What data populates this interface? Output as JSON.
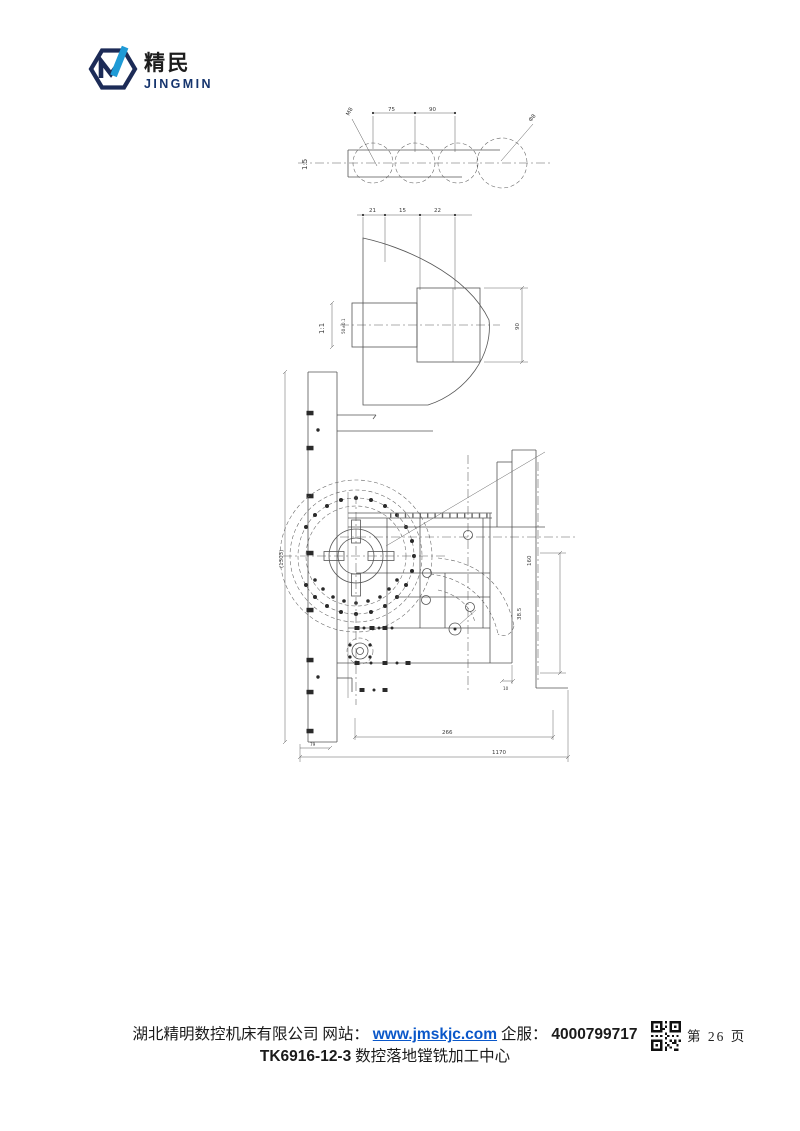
{
  "logo": {
    "brand_cn": "精民",
    "brand_en": "JINGMIN",
    "navy": "#1c2b57",
    "blue": "#1e9ad6"
  },
  "drawing": {
    "scale_top": "1:5",
    "scale_section": "1:1",
    "top": {
      "dim_a": "75",
      "dim_b": "90",
      "leader_left": "M8",
      "leader_right": "Φ8"
    },
    "section": {
      "dims_top": [
        "21",
        "15",
        "22"
      ],
      "dim_height": "90",
      "dim_slot": "50±0.1"
    },
    "main": {
      "dim_col": "(1303)",
      "dim_inner": "266",
      "dim_total": "1170",
      "dim_angle": "79",
      "dim_step": "10",
      "dim_r1": "160",
      "dim_r2": "38.5"
    }
  },
  "footer": {
    "company": "湖北精明数控机床有限公司",
    "site_label": "网站：",
    "site_url": "www.jmskjc.com",
    "service_label": "企服：",
    "service_phone": "4000799717",
    "page_number": "第 26 页",
    "model_code": "TK6916-12-3",
    "model_name": "数控落地镗铣加工中心",
    "link_color": "#0a57c9"
  }
}
